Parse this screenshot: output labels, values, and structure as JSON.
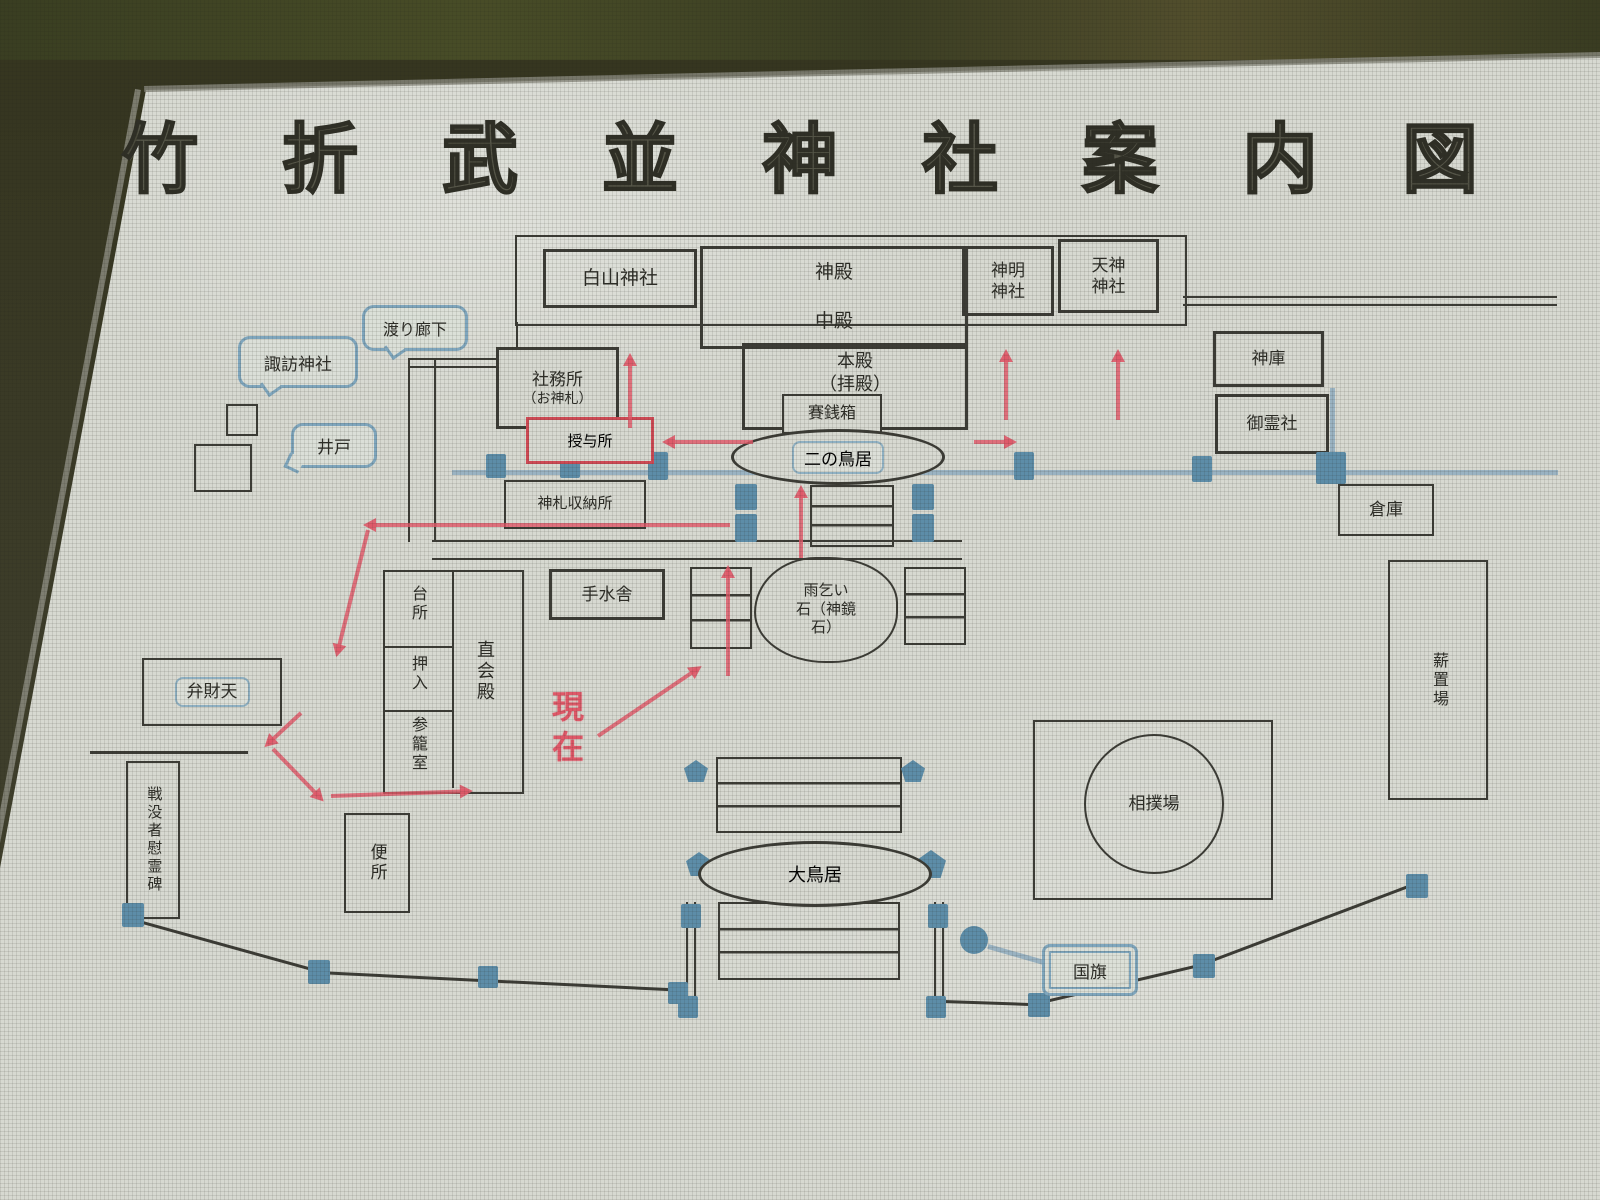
{
  "title": {
    "text": "竹折武並神社案内図"
  },
  "map": {
    "shrines": {
      "hakusan": "白山神社",
      "shinmei_l1": "神明",
      "shinmei_l2": "神社",
      "tenjin_l1": "天神",
      "tenjin_l2": "神社",
      "suwa": "諏訪神社",
      "benzaiten": "弁財天",
      "goreisha": "御霊社"
    },
    "halls": {
      "shinden": "神殿",
      "chuden": "中殿",
      "honden": "本殿",
      "haiden": "（拝殿）",
      "naoraiden": "直会殿"
    },
    "rooms": {
      "daidokoro": "台所",
      "oshiire": "押入",
      "sanroshitsu": "参籠室"
    },
    "facilities": {
      "shamusho_l1": "社務所",
      "shamusho_l2": "（お神札）",
      "juyosho": "授与所",
      "watari_roka": "渡り廊下",
      "ido": "井戸",
      "saisenbako": "賽銭箱",
      "shinsatsu_shunosho": "神札収納所",
      "temizusha": "手水舎",
      "shinko": "神庫",
      "soko": "倉庫",
      "makiokiba": "薪置場",
      "sumoba": "相撲場",
      "benjo": "便所",
      "ireihi": "戦没者慰霊碑",
      "kokki": "国旗"
    },
    "gates": {
      "ni_no_torii": "二の鳥居",
      "o_torii": "大鳥居"
    },
    "features": {
      "amagoi_l1": "雨乞い",
      "amagoi_l2": "石（神鏡",
      "amagoi_l3": "石）"
    },
    "marker": {
      "genzai": "現在"
    },
    "colors": {
      "route_red": "#df5868",
      "path_blue": "#9ab3c2",
      "post_blue": "#5d8da8",
      "line_dark": "#3c3c36",
      "board": "#d7d9d1",
      "red_box": "#cf4a55"
    }
  }
}
